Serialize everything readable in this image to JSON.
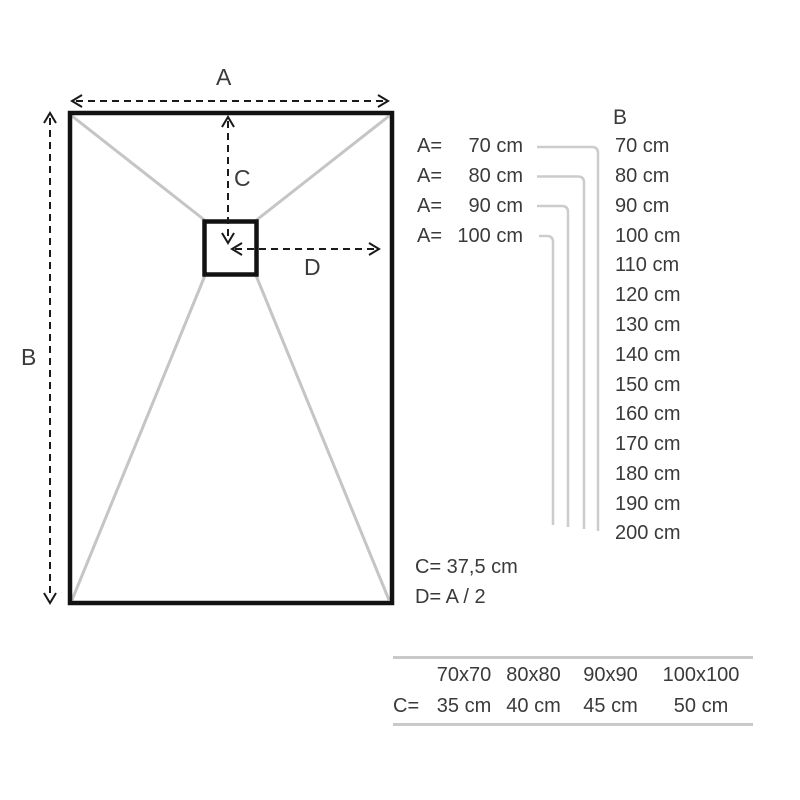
{
  "diagram": {
    "labels": {
      "a": "A",
      "b": "B",
      "c": "C",
      "d": "D"
    },
    "colors": {
      "outline": "#121212",
      "slope_lines": "#c5c5c5",
      "dimension_arrows": "#1a1a1a",
      "text": "#3a3a3a",
      "connector_lines": "#cccccc",
      "table_rule": "#c9c9c9"
    }
  },
  "side_panel": {
    "b_header": "B",
    "a_rows": [
      {
        "label": "A=",
        "value": "70 cm"
      },
      {
        "label": "A=",
        "value": "80 cm"
      },
      {
        "label": "A=",
        "value": "90 cm"
      },
      {
        "label": "A=",
        "value": "100 cm"
      }
    ],
    "b_values": [
      "70 cm",
      "80 cm",
      "90 cm",
      "100 cm",
      "110 cm",
      "120 cm",
      "130 cm",
      "140 cm",
      "150 cm",
      "160 cm",
      "170 cm",
      "180 cm",
      "190 cm",
      "200 cm"
    ],
    "formulas": {
      "c": "C= 37,5 cm",
      "d": "D= A / 2"
    }
  },
  "size_table": {
    "row_label": "C=",
    "sizes": [
      "70x70",
      "80x80",
      "90x90",
      "100x100"
    ],
    "c_values": [
      "35 cm",
      "40 cm",
      "45 cm",
      "50 cm"
    ]
  }
}
